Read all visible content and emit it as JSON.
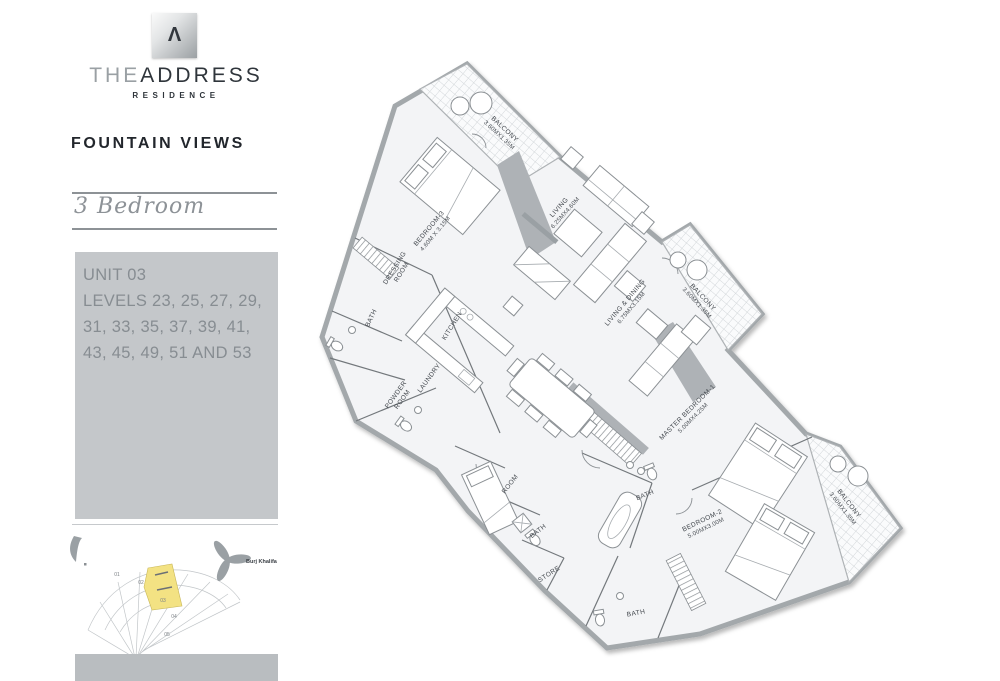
{
  "brand": {
    "logo_symbol": "Λ",
    "name_the": "THE",
    "name_address": "ADDRESS",
    "residence": "RESIDENCE"
  },
  "project": {
    "title": "FOUNTAIN VIEWS",
    "unit_type": "3 Bedroom"
  },
  "unit_info": {
    "unit": "UNIT 03",
    "levels_line1": "LEVELS 23, 25, 27, 29,",
    "levels_line2": "31, 33, 35, 37, 39, 41,",
    "levels_line3": "43, 45, 49, 51 AND 53"
  },
  "key_plan": {
    "landmark_label": "Burj Khalifa",
    "units": [
      "01",
      "02",
      "03",
      "04",
      "05"
    ],
    "highlighted_unit": "03",
    "highlight_color": "#F3E283"
  },
  "floor_plan": {
    "labels": {
      "balcony_top": {
        "l1": "BALCONY",
        "l2": "3.60MX1.35M"
      },
      "bedroom3": {
        "l1": "BEDROOM-3",
        "l2": "4.60M X 3.15M"
      },
      "dressing": {
        "l1": "DRESSING",
        "l2": "ROOM"
      },
      "bath_bedroom3": {
        "l1": "BATH"
      },
      "kitchen": {
        "l1": "KITCHEN"
      },
      "laundry": {
        "l1": "LAUNDRY"
      },
      "powder": {
        "l1": "POWDER",
        "l2": "ROOM"
      },
      "living": {
        "l1": "LIVING",
        "l2": "6.25MX4.60M"
      },
      "living_dining": {
        "l1": "LIVING & DINING",
        "l2": "6.75MX3.15M"
      },
      "balcony_right": {
        "l1": "BALCONY",
        "l2": "3.60MX1.35M"
      },
      "master_bedroom": {
        "l1": "MASTER BEDROOM-1",
        "l2": "5.00MX4.25M"
      },
      "bath_master": {
        "l1": "BATH"
      },
      "bedroom2": {
        "l1": "BEDROOM-2",
        "l2": "5.00MX3.00M"
      },
      "balcony_bottom": {
        "l1": "BALCONY",
        "l2": "3.60MX1.35M"
      },
      "maid_room": {
        "l1": "ROOM"
      },
      "bath_maid": {
        "l1": "BATH"
      },
      "store": {
        "l1": "STORE"
      },
      "bath_bedroom2": {
        "l1": "BATH"
      }
    }
  }
}
